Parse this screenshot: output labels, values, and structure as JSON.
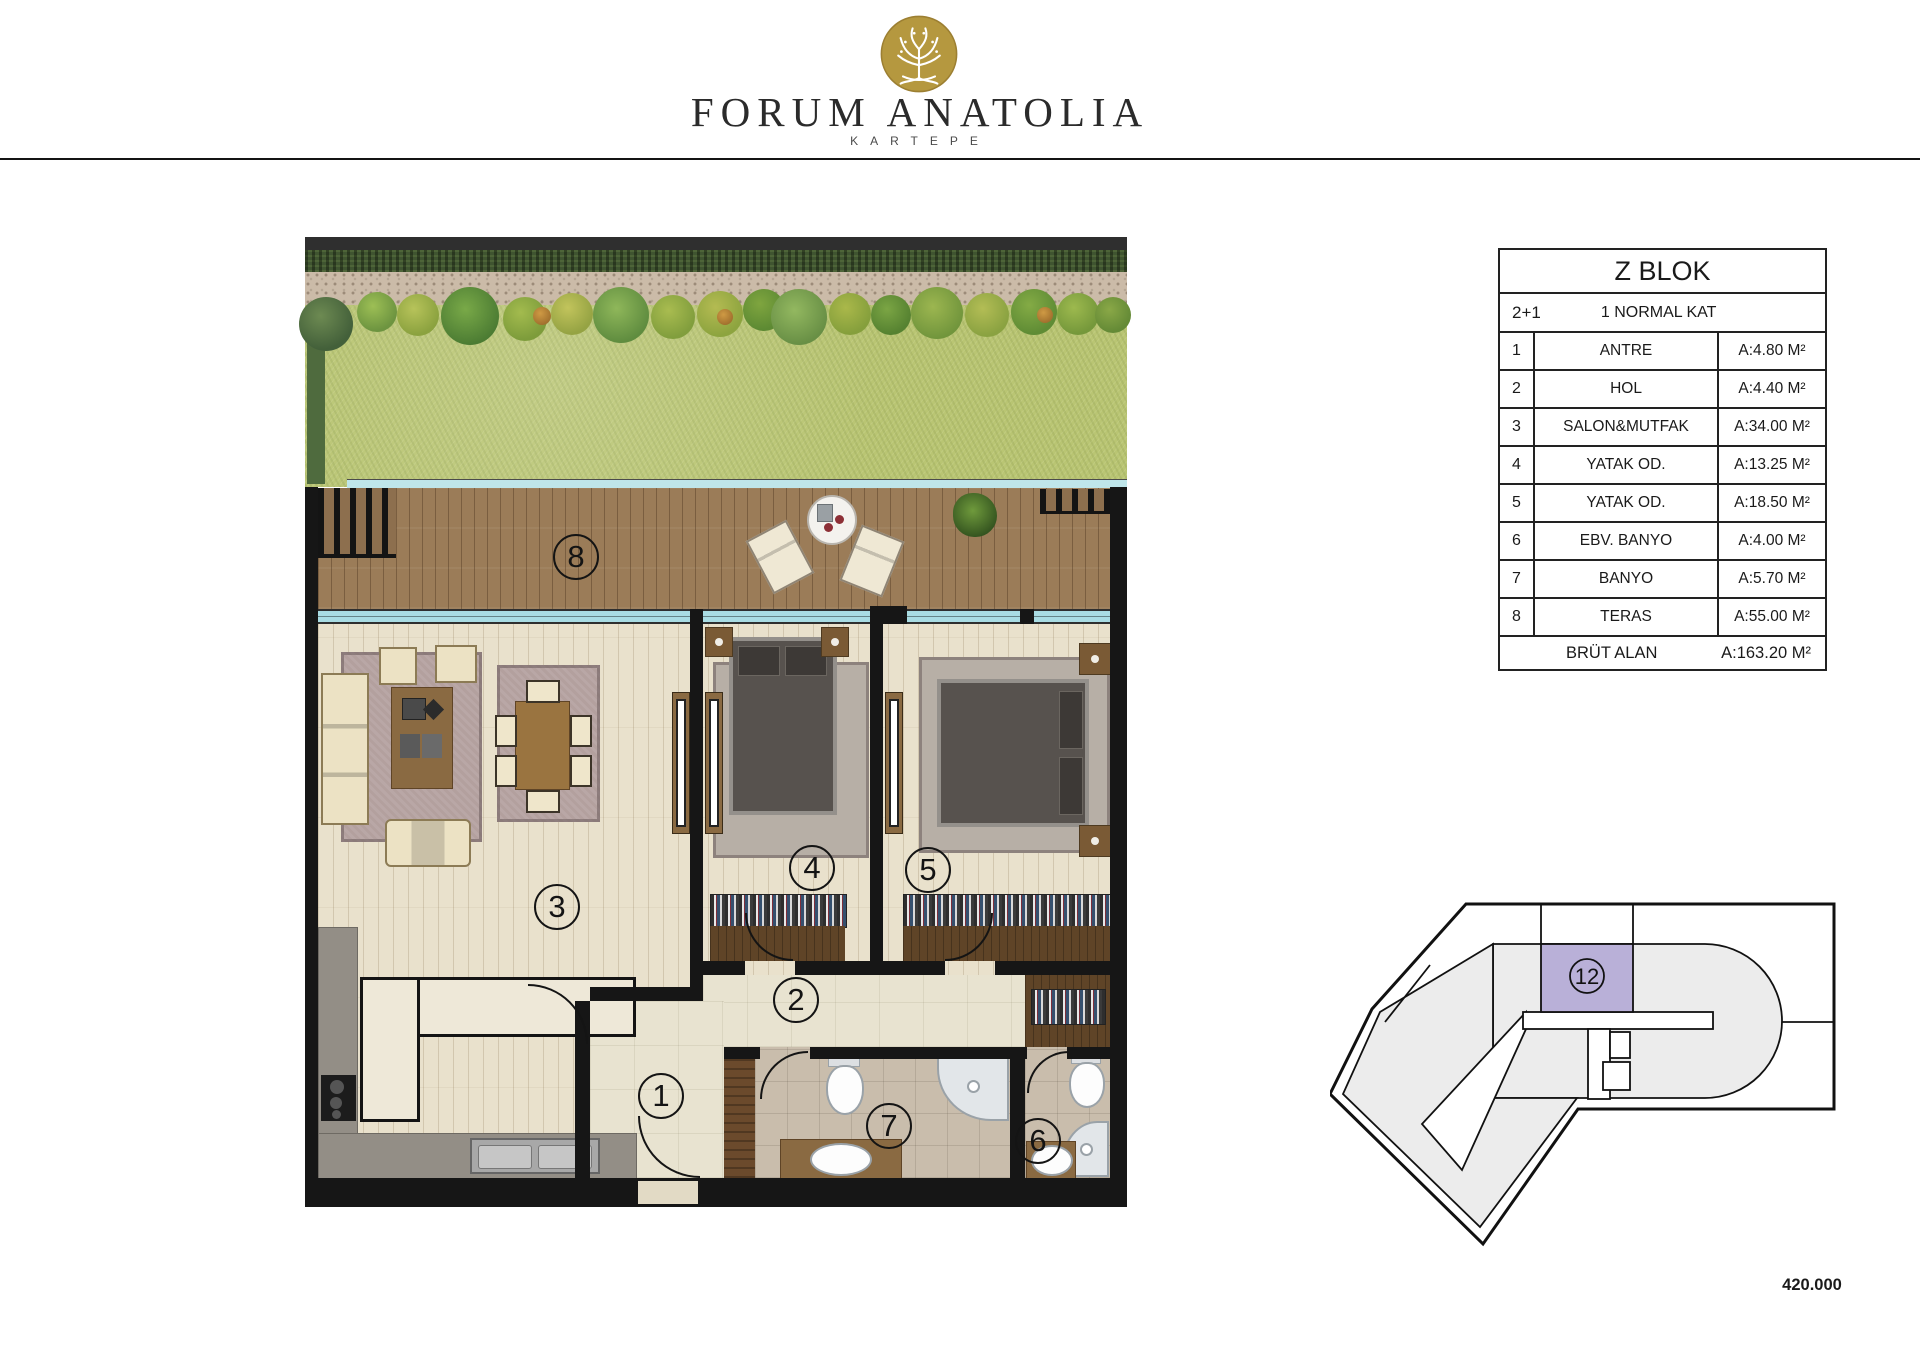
{
  "brand": {
    "name": "FORUM ANATOLIA",
    "location": "KARTEPE",
    "logo_icon": "tree-of-life-emblem",
    "gold_color": "#b5983f"
  },
  "unit_table": {
    "block_title": "Z BLOK",
    "unit_type": "2+1",
    "floor_label": "1 NORMAL KAT",
    "rows": [
      {
        "no": "1",
        "name": "ANTRE",
        "area": "A:4.80 M²"
      },
      {
        "no": "2",
        "name": "HOL",
        "area": "A:4.40 M²"
      },
      {
        "no": "3",
        "name": "SALON&MUTFAK",
        "area": "A:34.00 M²"
      },
      {
        "no": "4",
        "name": "YATAK OD.",
        "area": "A:13.25 M²"
      },
      {
        "no": "5",
        "name": "YATAK OD.",
        "area": "A:18.50 M²"
      },
      {
        "no": "6",
        "name": "EBV. BANYO",
        "area": "A:4.00 M²"
      },
      {
        "no": "7",
        "name": "BANYO",
        "area": "A:5.70 M²"
      },
      {
        "no": "8",
        "name": "TERAS",
        "area": "A:55.00 M²"
      }
    ],
    "total_label": "BRÜT ALAN",
    "total_area": "A:163.20 M²"
  },
  "floor_plan": {
    "room_labels": [
      "1",
      "2",
      "3",
      "4",
      "5",
      "6",
      "7",
      "8"
    ],
    "window_color": "#a9dce3",
    "deck_color": "#9b7c58",
    "grass_color": "#b9c573"
  },
  "key_plan": {
    "highlighted_unit": "12",
    "highlight_color": "#b9b0d8"
  },
  "price_note": "420.000"
}
